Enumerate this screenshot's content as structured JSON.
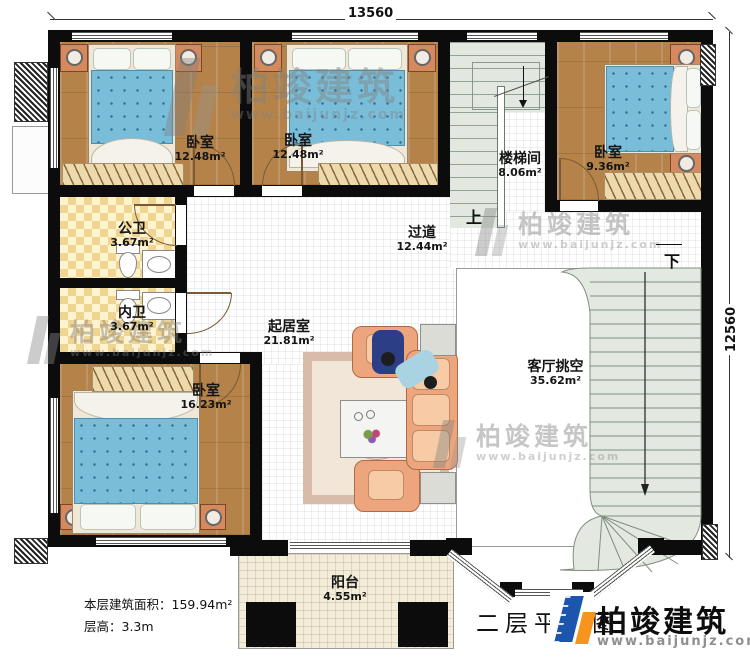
{
  "dims": {
    "top": "13560",
    "right": "12560"
  },
  "rooms": [
    {
      "id": "bedroom-top-left",
      "name": "卧室",
      "area": "12.48m²"
    },
    {
      "id": "bedroom-top-mid",
      "name": "卧室",
      "area": "12.48m²"
    },
    {
      "id": "stairwell",
      "name": "楼梯间",
      "area": "8.06m²"
    },
    {
      "id": "bedroom-top-right",
      "name": "卧室",
      "area": "9.36m²"
    },
    {
      "id": "public-bathroom",
      "name": "公卫",
      "area": "3.67m²"
    },
    {
      "id": "hallway",
      "name": "过道",
      "area": "12.44m²"
    },
    {
      "id": "private-bathroom",
      "name": "内卫",
      "area": "3.67m²"
    },
    {
      "id": "sitting-room",
      "name": "起居室",
      "area": "21.81m²"
    },
    {
      "id": "bedroom-bottom",
      "name": "卧室",
      "area": "16.23m²"
    },
    {
      "id": "living-void",
      "name": "客厅挑空",
      "area": "35.62m²"
    },
    {
      "id": "balcony",
      "name": "阳台",
      "area": "4.55m²"
    }
  ],
  "stairs": {
    "up": "上",
    "down": "下"
  },
  "footer": {
    "area_line": "本层建筑面积：159.94m²",
    "height_line": "层高：3.3m",
    "plan_title": "二层平面图"
  },
  "brand": {
    "name": "柏竣建筑",
    "url": "www.baijunjz.com"
  },
  "watermark": {
    "name": "柏竣建筑",
    "url": "www.baijunjz.com"
  },
  "colors": {
    "wall": "#0c0c0c",
    "wood_floor": "#b5834a",
    "bed": "#7abdd8",
    "sofa": "#eca57d",
    "bath_tile": "#f0d592",
    "stair": "#e2e8e0",
    "balcony": "#f2ecd9",
    "brand_blue": "#1b55ad",
    "brand_orange": "#f7941d",
    "watermark_gray": "#8c8c8c"
  }
}
